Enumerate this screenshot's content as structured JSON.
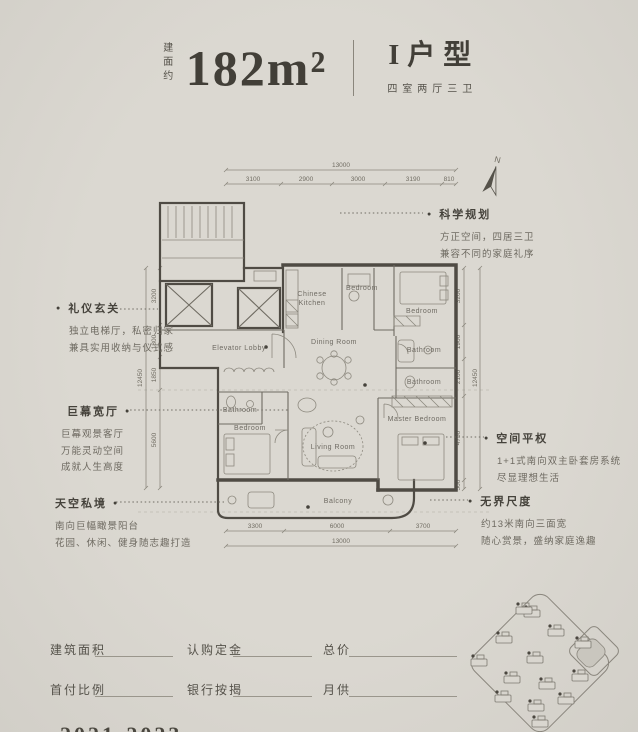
{
  "title": {
    "prefix": "建面约",
    "area": "182m²",
    "type": "I户型",
    "subtitle": "四室两厅三卫"
  },
  "north_label": "N",
  "plan": {
    "rooms": {
      "elevator_lobby": "Elevator Lobby",
      "kitchen1": "Chinese",
      "kitchen2": "Kitchen",
      "bedroom_top": "Bedroom",
      "bedroom_right": "Bedroom",
      "dining": "Dining Room",
      "bath_right1": "Bathroom",
      "bath_right2": "Bathroom",
      "bath_left": "Bathroom",
      "bedroom_left": "Bedroom",
      "living": "Living Room",
      "master": "Master Bedroom",
      "balcony": "Balcony"
    },
    "dims": {
      "top_total": "13000",
      "top": [
        "3100",
        "2900",
        "3000",
        "3190",
        "810"
      ],
      "bottom": [
        "3300",
        "6000",
        "3700"
      ],
      "bottom_total": "13000",
      "left": [
        "3200",
        "1800",
        "1850",
        "5600"
      ],
      "left_total": "12450",
      "right": [
        "3200",
        "1900",
        "2100",
        "4750",
        "500"
      ],
      "right_total": "12450"
    }
  },
  "annotations": {
    "left": [
      {
        "title": "礼仪玄关",
        "lines": [
          "独立电梯厅，私密归家",
          "兼具实用收纳与仪式感"
        ]
      },
      {
        "title": "巨幕宽厅",
        "lines": [
          "巨幕观景客厅",
          "万能灵动空间",
          "成就人生高度"
        ]
      },
      {
        "title": "天空私境",
        "lines": [
          "南向巨幅瞰景阳台",
          "花园、休闲、健身随志趣打造"
        ]
      }
    ],
    "right": [
      {
        "title": "科学规划",
        "lines": [
          "方正空间，四居三卫",
          "兼容不同的家庭礼序"
        ]
      },
      {
        "title": "空间平权",
        "lines": [
          "1+1式南向双主卧套房系统",
          "尽显理想生活"
        ]
      },
      {
        "title": "无界尺度",
        "lines": [
          "约13米南向三面宽",
          "随心赏景，盛纳家庭逸趣"
        ]
      }
    ]
  },
  "form": {
    "fields": [
      {
        "label": "建筑面积"
      },
      {
        "label": "认购定金"
      },
      {
        "label": "总价"
      },
      {
        "label": "首付比例"
      },
      {
        "label": "银行按揭"
      },
      {
        "label": "月供"
      }
    ]
  },
  "footer_partial": "2021-2023",
  "sitemap": {
    "buildings": [
      [
        532,
        610
      ],
      [
        556,
        629
      ],
      [
        504,
        636
      ],
      [
        479,
        659
      ],
      [
        535,
        656
      ],
      [
        583,
        641
      ],
      [
        512,
        676
      ],
      [
        547,
        682
      ],
      [
        580,
        674
      ],
      [
        503,
        695
      ],
      [
        536,
        704
      ],
      [
        566,
        697
      ],
      [
        540,
        720
      ],
      [
        524,
        607
      ]
    ]
  },
  "colors": {
    "bg": "#d9d6cf",
    "ink": "#44413a",
    "line": "#55524c",
    "muted": "#6f6b62"
  }
}
